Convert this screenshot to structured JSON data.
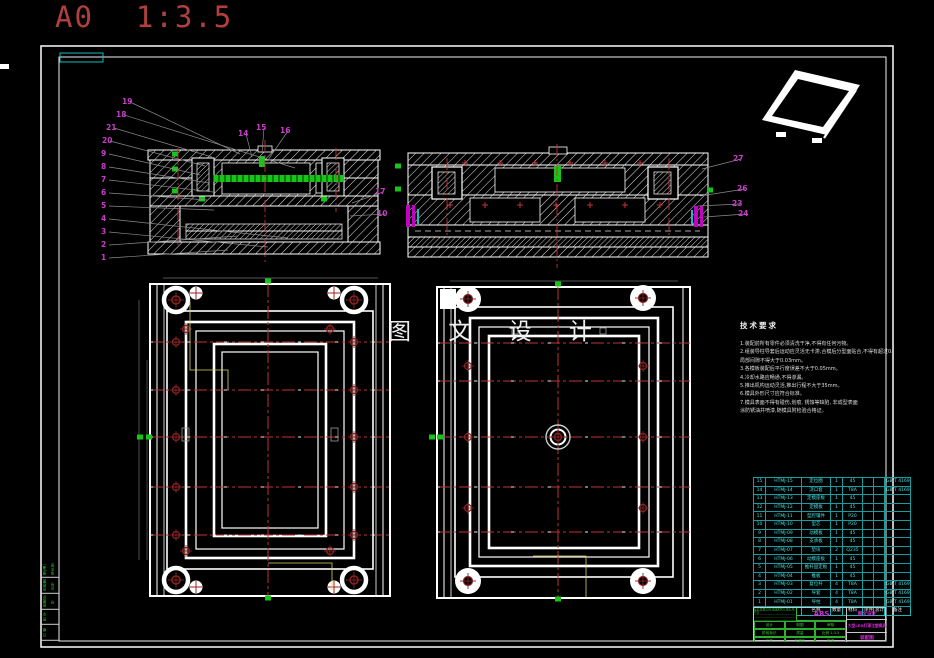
{
  "sheet": {
    "format": "A0",
    "scale": "1:3.5"
  },
  "watermark": "图 文 设 计",
  "tech_requirements": {
    "title": "技术要求",
    "lines": [
      "1.装配前所有零件必须清洗干净,不得有任何污物。",
      "2.组装导柱导套后运动应灵活无卡滞,合模后分型面贴合,不得有超过0.02的间隙,",
      "  局部间隙不得大于0.03mm。",
      "3.各模板装配后平行度误差不大于0.05mm。",
      "4.冷却水路应畅通,不得渗漏。",
      "5.推出机构运动灵活,推出行程不大于35mm。",
      "6.模具外形尺寸应符合标准。",
      "7.模具表面不得有碰伤,划痕, 锈蚀等缺陷, 非成型表面",
      "  涂防锈油并喷漆,随模具附检验合格证。"
    ]
  },
  "balloons": [
    {
      "n": "19",
      "x": 122,
      "y": 98,
      "tx": 240,
      "ty": 154
    },
    {
      "n": "18",
      "x": 116,
      "y": 111,
      "tx": 295,
      "ty": 168
    },
    {
      "n": "21",
      "x": 106,
      "y": 124,
      "tx": 212,
      "ty": 157
    },
    {
      "n": "20",
      "x": 102,
      "y": 137,
      "tx": 205,
      "ty": 166
    },
    {
      "n": "9",
      "x": 101,
      "y": 150,
      "tx": 200,
      "ty": 175
    },
    {
      "n": "8",
      "x": 101,
      "y": 163,
      "tx": 209,
      "ty": 183
    },
    {
      "n": "7",
      "x": 101,
      "y": 176,
      "tx": 213,
      "ty": 192
    },
    {
      "n": "6",
      "x": 101,
      "y": 189,
      "tx": 207,
      "ty": 200
    },
    {
      "n": "5",
      "x": 101,
      "y": 202,
      "tx": 214,
      "ty": 210
    },
    {
      "n": "4",
      "x": 101,
      "y": 215,
      "tx": 288,
      "ty": 238
    },
    {
      "n": "3",
      "x": 101,
      "y": 228,
      "tx": 268,
      "ty": 247
    },
    {
      "n": "2",
      "x": 101,
      "y": 241,
      "tx": 238,
      "ty": 236
    },
    {
      "n": "1",
      "x": 101,
      "y": 254,
      "tx": 228,
      "ty": 250
    },
    {
      "n": "14",
      "x": 238,
      "y": 130,
      "tx": 252,
      "ty": 157
    },
    {
      "n": "15",
      "x": 256,
      "y": 124,
      "tx": 262,
      "ty": 153
    },
    {
      "n": "16",
      "x": 280,
      "y": 127,
      "tx": 268,
      "ty": 160
    },
    {
      "n": "17",
      "x": 375,
      "y": 188,
      "tx": 352,
      "ty": 203
    },
    {
      "n": "10",
      "x": 377,
      "y": 210,
      "tx": 350,
      "ty": 216
    },
    {
      "n": "27",
      "x": 733,
      "y": 155,
      "tx": 702,
      "ty": 169
    },
    {
      "n": "26",
      "x": 737,
      "y": 185,
      "tx": 700,
      "ty": 196
    },
    {
      "n": "23",
      "x": 732,
      "y": 200,
      "tx": 698,
      "ty": 206
    },
    {
      "n": "24",
      "x": 738,
      "y": 210,
      "tx": 704,
      "ty": 217
    }
  ],
  "bom": {
    "headers": [
      "序号",
      "代号",
      "名称",
      "数量",
      "材料",
      "单件",
      "总计",
      "备注"
    ],
    "rows": [
      [
        "15",
        "HTMJ-15",
        "定位圈",
        "1",
        "45",
        "",
        "",
        "GB/T 4169.18"
      ],
      [
        "14",
        "HTMJ-14",
        "浇口套",
        "1",
        "T8A",
        "",
        "",
        "GB/T 4169.19"
      ],
      [
        "13",
        "HTMJ-13",
        "定模座板",
        "1",
        "45",
        "",
        "",
        ""
      ],
      [
        "12",
        "HTMJ-12",
        "定模板",
        "1",
        "45",
        "",
        "",
        ""
      ],
      [
        "11",
        "HTMJ-11",
        "型腔镶件",
        "1",
        "P20",
        "",
        "",
        ""
      ],
      [
        "10",
        "HTMJ-10",
        "型芯",
        "1",
        "P20",
        "",
        "",
        ""
      ],
      [
        "9",
        "HTMJ-09",
        "动模板",
        "1",
        "45",
        "",
        "",
        ""
      ],
      [
        "8",
        "HTMJ-08",
        "支承板",
        "1",
        "45",
        "",
        "",
        ""
      ],
      [
        "7",
        "HTMJ-07",
        "垫块",
        "2",
        "Q235",
        "",
        "",
        ""
      ],
      [
        "6",
        "HTMJ-06",
        "动模座板",
        "1",
        "45",
        "",
        "",
        ""
      ],
      [
        "5",
        "HTMJ-05",
        "推杆固定板",
        "1",
        "45",
        "",
        "",
        ""
      ],
      [
        "4",
        "HTMJ-04",
        "推板",
        "1",
        "45",
        "",
        "",
        ""
      ],
      [
        "3",
        "HTMJ-03",
        "复位杆",
        "4",
        "T8A",
        "",
        "",
        "GB/T 4169.13"
      ],
      [
        "2",
        "HTMJ-02",
        "导套",
        "4",
        "T8A",
        "",
        "",
        "GB/T 4169.3"
      ],
      [
        "1",
        "HTMJ-01",
        "导柱",
        "4",
        "T8A",
        "",
        "",
        "GB/T 4169.4"
      ]
    ]
  },
  "title_block": {
    "company": "图文设计",
    "material": "ABS",
    "title": "大型LED灯罩注塑模具",
    "drawing_type": "装配图",
    "rev_row": "标记 处数 分区 更改文件号 签名 年月日",
    "sig_labels": [
      "设计",
      "制图",
      "审核",
      "阶段标记",
      "质量",
      "比例 1:3.5",
      "工艺",
      "标准化",
      "批准",
      "共1张",
      "第1张",
      ""
    ]
  },
  "margin_labels": [
    "借(通)用件登记",
    "旧底图总号",
    "底图总号",
    "签 字",
    "日 期"
  ]
}
